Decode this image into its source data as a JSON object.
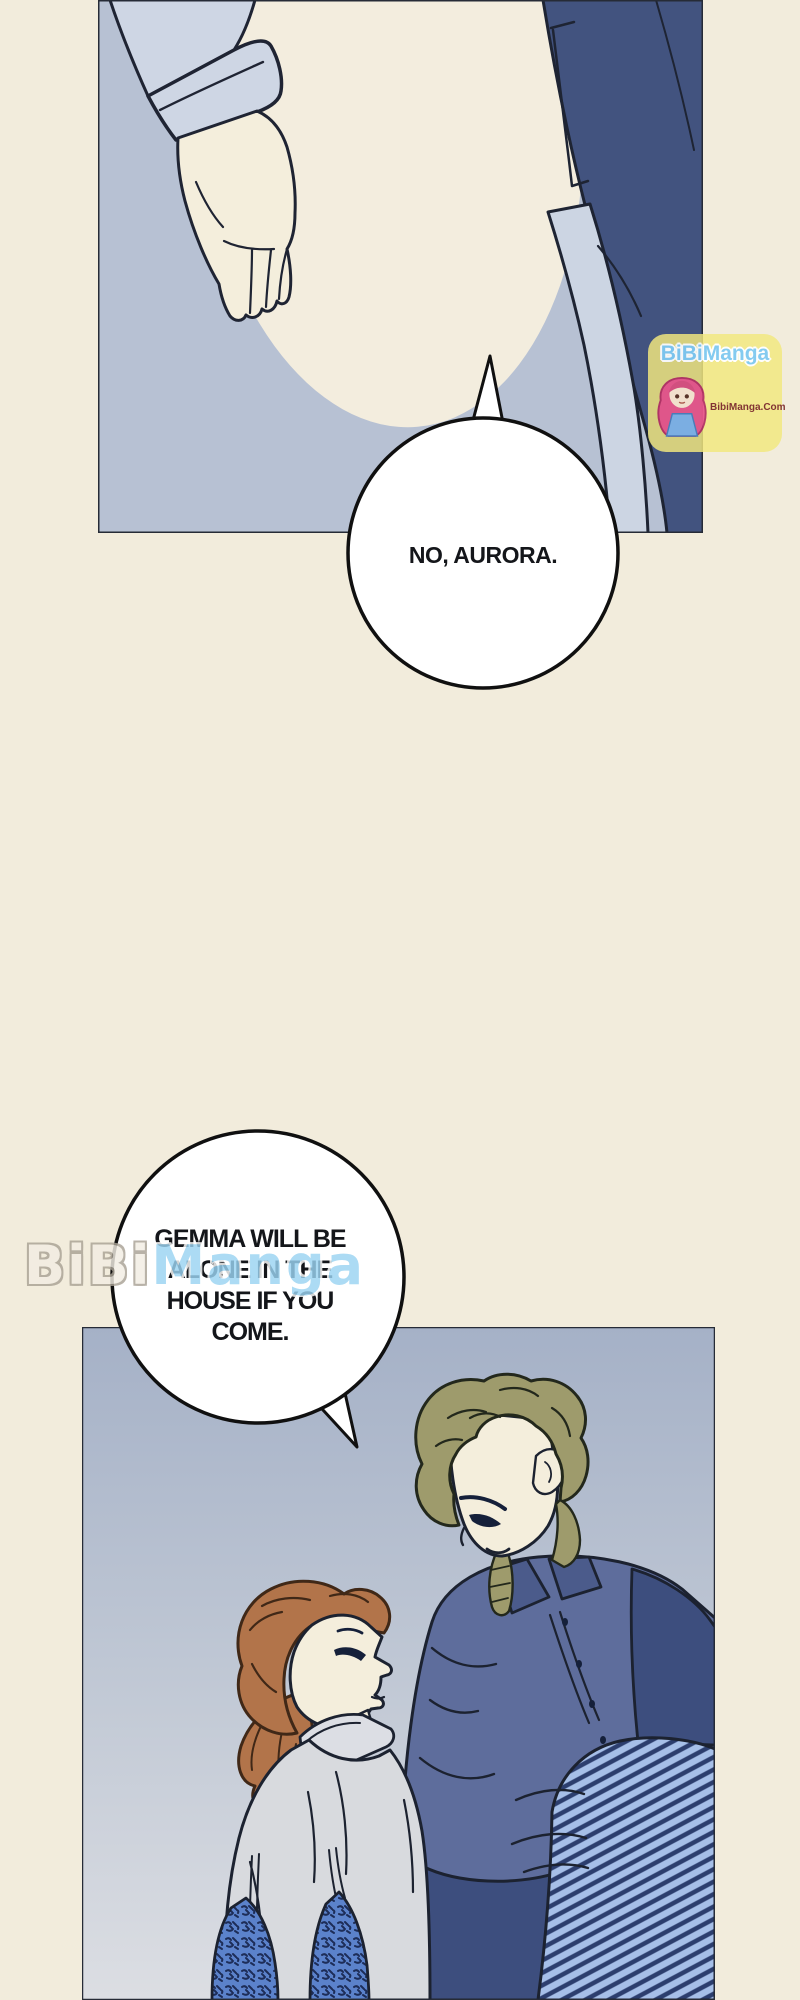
{
  "page": {
    "type_label": "manga-page"
  },
  "speech": {
    "bubble1": {
      "text": "NO, AURORA."
    },
    "bubble2": {
      "lines": [
        "GEMMA WILL BE",
        "ALONE IN THE",
        "HOUSE IF YOU",
        "COME."
      ]
    }
  },
  "watermark_badge": {
    "title_part1": "BiBi",
    "title_part2": "Manga",
    "domain": "BibiManga.Com"
  },
  "watermark_side": {
    "part1": "BiBi",
    "part2": "Manga"
  },
  "colors": {
    "page_background": "#f2ecdc",
    "panel1_background": "#b7c1d3",
    "panel2_background_top": "#a5b1c7",
    "panel2_background_bottom": "#dcdee3",
    "navy_clothing": "#42537f",
    "slate_shirt": "#5e6d9c",
    "stripe_light": "#a6bfe8",
    "stripe_dark": "#2c3e6e",
    "olive_hair": "#9e9b6c",
    "auburn_hair": "#b2744a",
    "skin": "#f4eedc",
    "skirt_blue": "#5b82cb",
    "badge_yellow": "#f3e87f",
    "badge_text_blue": "#7fcaf2",
    "badge_domain_red": "#7c2b2b",
    "bubble_fill": "#ffffff"
  }
}
